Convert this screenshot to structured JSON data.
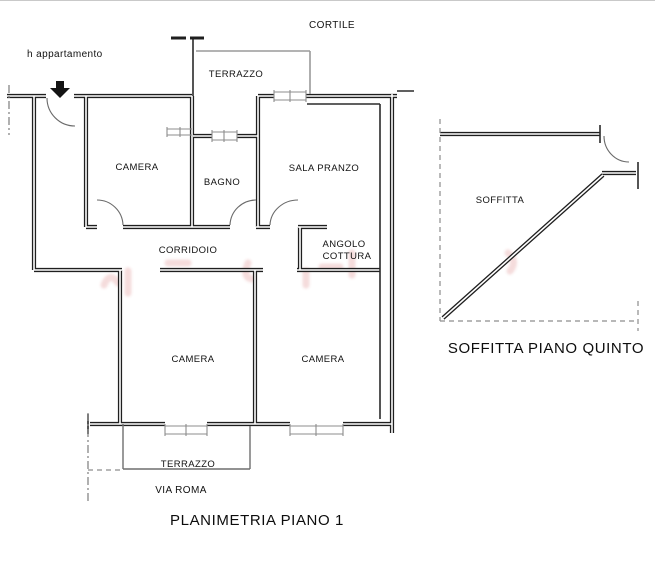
{
  "document": {
    "type": "floor-plan-drawing",
    "background_color": "#ffffff",
    "wall_color": "#1f1f1f",
    "accent_watermark_color": "rgba(205,75,75,0.2)"
  },
  "plan_main": {
    "title": "PLANIMETRIA PIANO 1",
    "annotations": {
      "entrance_note": "h appartamento",
      "courtyard": "CORTILE",
      "street": "VIA ROMA"
    },
    "rooms": {
      "terrazzo_top": "TERRAZZO",
      "camera_top": "CAMERA",
      "bagno": "BAGNO",
      "sala_pranzo": "SALA PRANZO",
      "corridoio": "CORRIDOIO",
      "angolo_line1": "ANGOLO",
      "angolo_line2": "COTTURA",
      "camera_bottom_left": "CAMERA",
      "camera_bottom_right": "CAMERA",
      "terrazzo_bottom": "TERRAZZO"
    }
  },
  "plan_attic": {
    "title": "SOFFITTA PIANO QUINTO",
    "rooms": {
      "soffitta": "SOFFITTA"
    }
  }
}
